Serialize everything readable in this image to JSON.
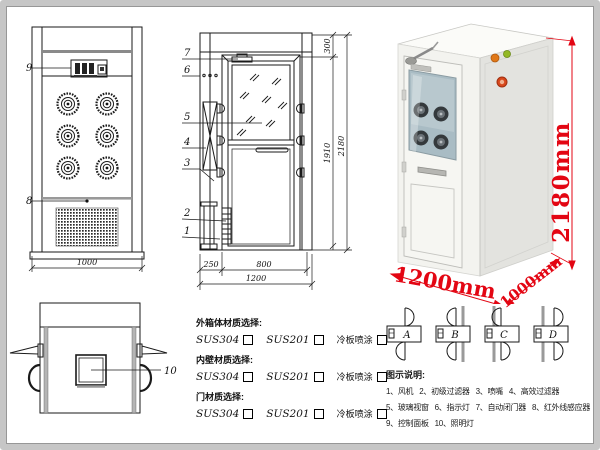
{
  "front_view": {
    "label_9": "9",
    "label_8": "8",
    "dim_width": "1000"
  },
  "section_view": {
    "label_1": "1",
    "label_2": "2",
    "label_3": "3",
    "label_4": "4",
    "label_5": "5",
    "label_6": "6",
    "label_7": "7",
    "dim_top": "300",
    "dim_door_height": "1910",
    "dim_total_height": "2180",
    "dim_left": "250",
    "dim_door_width": "800",
    "dim_total_width": "1200"
  },
  "top_view": {
    "label_10": "10"
  },
  "materials": {
    "group1_title": "外箱体材质选择:",
    "group2_title": "内壁材质选择:",
    "group3_title": "门材质选择:",
    "opt_1": "SUS304",
    "opt_2": "SUS201",
    "opt_3": "冷板喷涂"
  },
  "photo": {
    "dim_height": "2180mm",
    "dim_width": "1200mm",
    "dim_depth": "1000mm"
  },
  "door_configs": {
    "a": "A",
    "b": "B",
    "c": "C",
    "d": "D"
  },
  "legend": {
    "title": "图示说明:",
    "row1": [
      "1、风机",
      "2、初级过滤器",
      "3、喷嘴",
      "4、高效过滤器"
    ],
    "row2": [
      "5、玻璃视窗",
      "6、指示灯",
      "7、自动闭门器",
      "8、红外线感应器"
    ],
    "row3": [
      "9、控制面板",
      "10、照明灯"
    ]
  },
  "colors": {
    "dimension_red": "#e30613",
    "line": "#1a1a1a"
  }
}
